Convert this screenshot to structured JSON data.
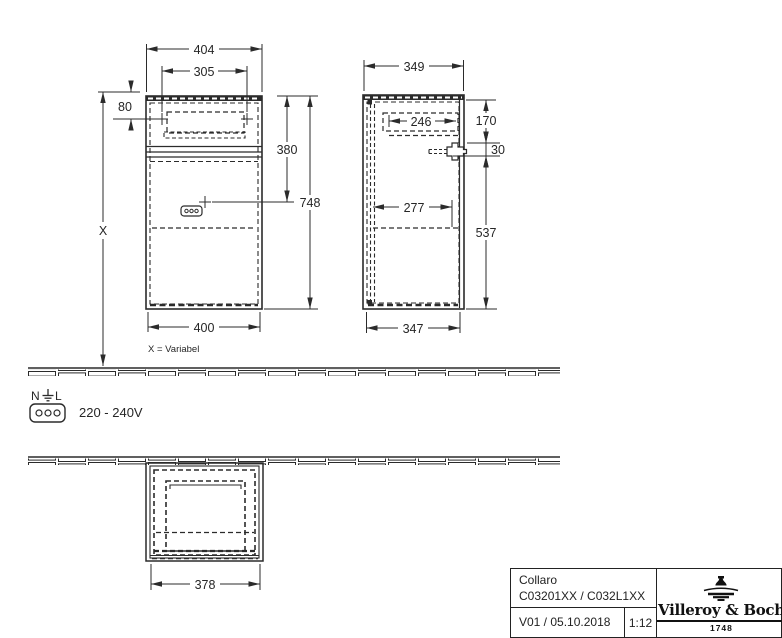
{
  "views": {
    "front": {
      "dims": {
        "top_width": "404",
        "handle_spacing": "305",
        "handle_offset": "80",
        "socket_height": "380",
        "total_height": "748",
        "bottom_width": "400",
        "wall_height": "X"
      },
      "note": "X = Variabel"
    },
    "side": {
      "dims": {
        "top_depth": "349",
        "drawer_depth": "246",
        "bracket_offset": "170",
        "bracket_height": "30",
        "shelf_depth": "277",
        "lower_height": "537",
        "bottom_depth": "347"
      }
    },
    "bottom": {
      "dims": {
        "width": "378"
      }
    }
  },
  "electrical": {
    "neutral": "N",
    "line": "L",
    "voltage": "220 - 240V"
  },
  "title_block": {
    "product_name": "Collaro",
    "article_numbers": "C03201XX / C032L1XX",
    "version_date": "V01 / 05.10.2018",
    "scale": "1:12",
    "brand": "Villeroy & Boch",
    "brand_year": "1748"
  }
}
